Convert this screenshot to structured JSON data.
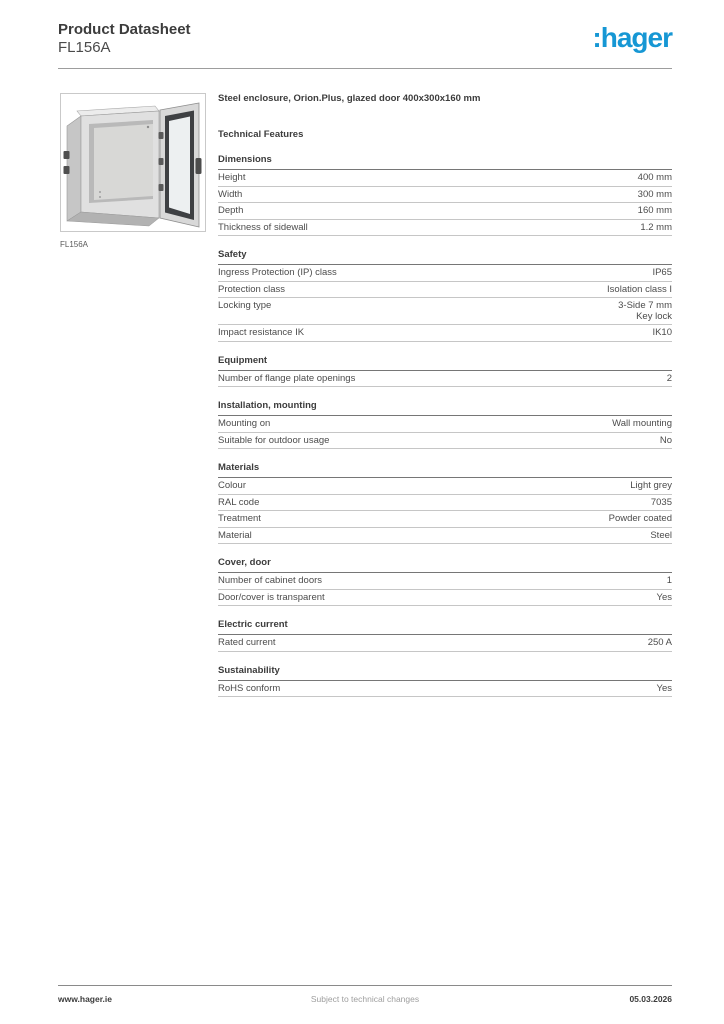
{
  "header": {
    "title": "Product Datasheet",
    "product_code": "FL156A",
    "logo_text": ":hager",
    "logo_color": "#1697d4"
  },
  "product": {
    "image_caption": "FL156A",
    "title": "Steel enclosure, Orion.Plus, glazed door 400x300x160 mm"
  },
  "technical": {
    "heading": "Technical Features",
    "sections": [
      {
        "title": "Dimensions",
        "rows": [
          {
            "label": "Height",
            "value": "400 mm"
          },
          {
            "label": "Width",
            "value": "300 mm"
          },
          {
            "label": "Depth",
            "value": "160 mm"
          },
          {
            "label": "Thickness of sidewall",
            "value": "1.2 mm"
          }
        ]
      },
      {
        "title": "Safety",
        "rows": [
          {
            "label": "Ingress Protection (IP) class",
            "value": "IP65"
          },
          {
            "label": "Protection class",
            "value": "Isolation class I"
          },
          {
            "label": "Locking type",
            "value": "3-Side 7 mm\nKey lock"
          },
          {
            "label": "Impact resistance IK",
            "value": "IK10"
          }
        ]
      },
      {
        "title": "Equipment",
        "rows": [
          {
            "label": "Number of flange plate openings",
            "value": "2"
          }
        ]
      },
      {
        "title": "Installation, mounting",
        "rows": [
          {
            "label": "Mounting on",
            "value": "Wall mounting"
          },
          {
            "label": "Suitable for outdoor usage",
            "value": "No"
          }
        ]
      },
      {
        "title": "Materials",
        "rows": [
          {
            "label": "Colour",
            "value": "Light grey"
          },
          {
            "label": "RAL code",
            "value": "7035"
          },
          {
            "label": "Treatment",
            "value": "Powder coated"
          },
          {
            "label": "Material",
            "value": "Steel"
          }
        ]
      },
      {
        "title": "Cover, door",
        "rows": [
          {
            "label": "Number of cabinet doors",
            "value": "1"
          },
          {
            "label": "Door/cover is transparent",
            "value": "Yes"
          }
        ]
      },
      {
        "title": "Electric current",
        "rows": [
          {
            "label": "Rated current",
            "value": "250 A"
          }
        ]
      },
      {
        "title": "Sustainability",
        "rows": [
          {
            "label": "RoHS conform",
            "value": "Yes"
          }
        ]
      }
    ]
  },
  "footer": {
    "website": "www.hager.ie",
    "note": "Subject to technical changes",
    "date": "05.03.2026"
  }
}
